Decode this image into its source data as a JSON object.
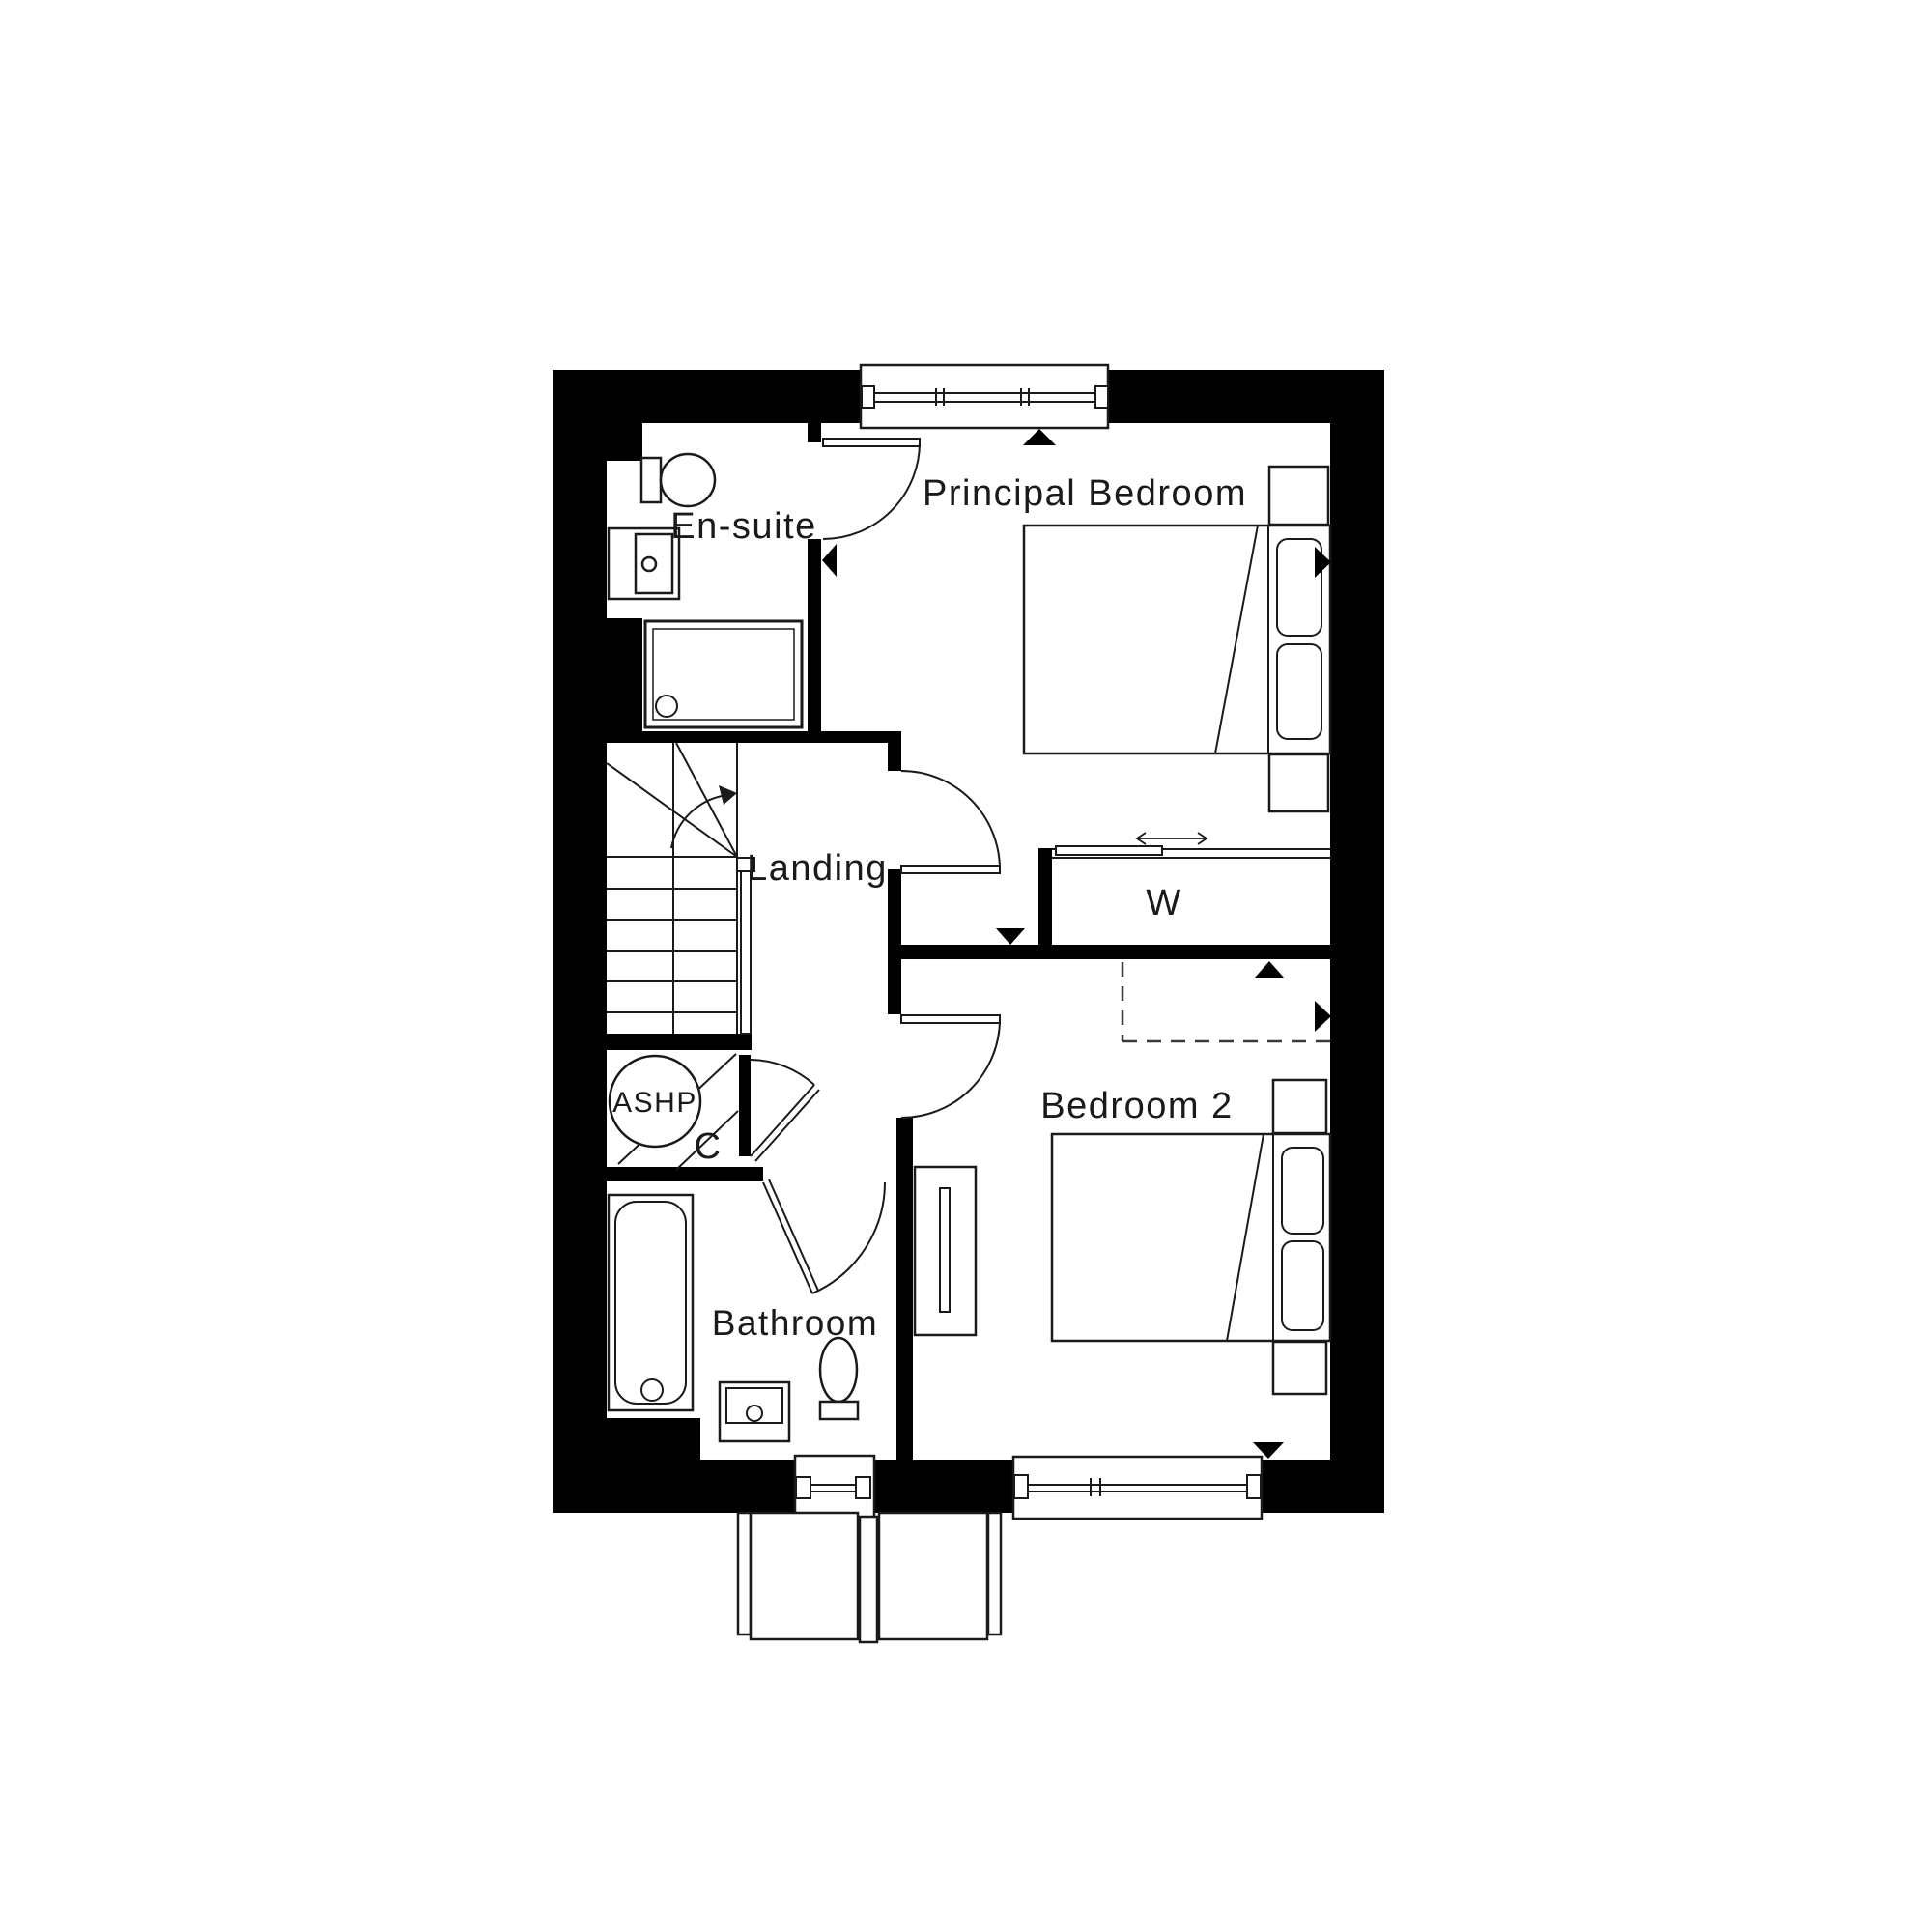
{
  "plan": {
    "rooms": {
      "principal_bedroom": {
        "label": "Principal Bedroom"
      },
      "en_suite": {
        "label": "En-suite"
      },
      "landing": {
        "label": "Landing"
      },
      "wardrobe": {
        "label": "W"
      },
      "ashp": {
        "label": "ASHP"
      },
      "cupboard": {
        "label": "C"
      },
      "bathroom": {
        "label": "Bathroom"
      },
      "bedroom_2": {
        "label": "Bedroom 2"
      }
    },
    "colors": {
      "wall": "#000000",
      "line": "#1a1a1a",
      "background": "#ffffff"
    }
  }
}
